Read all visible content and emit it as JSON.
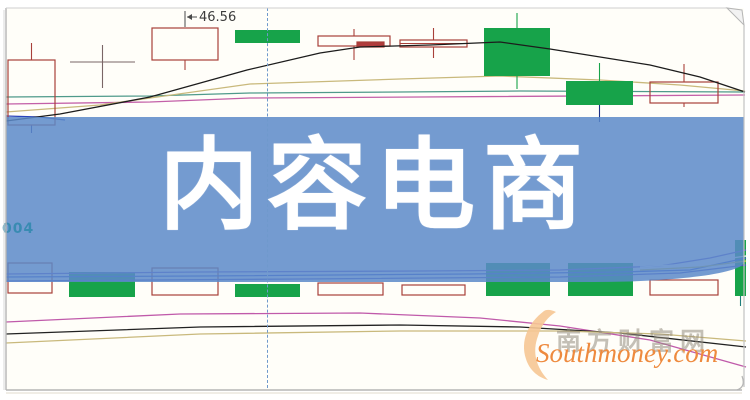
{
  "banner": {
    "title": "内容电商",
    "text_color": "#ffffff",
    "background": "rgba(92,138,201,0.85)"
  },
  "chart": {
    "price_label": "46.56",
    "left_axis_label": "004"
  },
  "watermark": {
    "site_name_cn": "南方财富网",
    "site_url": "Southmoney.com",
    "url_color": "#ee8a3e",
    "swoosh_color": "#f6c793"
  },
  "colors": {
    "red_outline": "#a8403a",
    "red_solid": "#b03c3c",
    "green": "#17a34a",
    "doji": "#7a6666",
    "chart_bg": "#fffef9",
    "frame": "#b5b5b5"
  },
  "chart_data": {
    "type": "candlestick",
    "title": "内容电商",
    "note": "Stock chart mostly covered by banner; no axis scale visible. Geometry given in screenshot pixel coordinates. Only labeled price value is 46.56.",
    "cursor_line": {
      "x": 267,
      "style": "dashed",
      "color": "#6f99cc"
    },
    "annotations": [
      {
        "text": "46.56",
        "x": 199,
        "y": 10,
        "callout_lines": [
          [
            [
              185,
              27
            ],
            [
              185,
              11
            ]
          ],
          [
            [
              187,
              17
            ],
            [
              197,
              17
            ]
          ]
        ]
      }
    ],
    "panes": {
      "price": {
        "ma_lines": [
          {
            "name": "ma-teal",
            "color": "#4f9a8b",
            "points": [
              [
                6,
                97
              ],
              [
                150,
                96
              ],
              [
                250,
                93
              ],
              [
                400,
                92
              ],
              [
                520,
                91
              ],
              [
                745,
                92
              ]
            ]
          },
          {
            "name": "ma-magenta",
            "color": "#c360a8",
            "points": [
              [
                6,
                104
              ],
              [
                150,
                102
              ],
              [
                250,
                98
              ],
              [
                420,
                97
              ],
              [
                745,
                95
              ]
            ]
          },
          {
            "name": "ma-tan",
            "color": "#c9b97c",
            "points": [
              [
                6,
                112
              ],
              [
                100,
                105
              ],
              [
                250,
                84
              ],
              [
                400,
                79
              ],
              [
                500,
                76
              ],
              [
                600,
                80
              ],
              [
                680,
                85
              ],
              [
                745,
                91
              ]
            ]
          },
          {
            "name": "ma-blue",
            "color": "#2a44bb",
            "points": [
              [
                6,
                116
              ],
              [
                40,
                117
              ],
              [
                65,
                120
              ]
            ]
          }
        ],
        "overlay_line": {
          "name": "ma-black",
          "color": "#1c1c1c",
          "points": [
            [
              6,
              121
            ],
            [
              60,
              114
            ],
            [
              150,
              97
            ],
            [
              247,
              70
            ],
            [
              320,
              53
            ],
            [
              360,
              47
            ],
            [
              430,
              45
            ],
            [
              500,
              42
            ],
            [
              550,
              49
            ],
            [
              650,
              65
            ],
            [
              700,
              77
            ],
            [
              745,
              92
            ]
          ]
        },
        "candles": [
          {
            "x": 8,
            "w": 47,
            "kind": "hollow",
            "body": [
              60,
              125
            ],
            "wick_top": 43,
            "wick_bottom": 133,
            "wick_bottom_color": "#2a3a9a"
          },
          {
            "x": 70,
            "w": 65,
            "kind": "doji",
            "body": [
              62,
              62
            ],
            "wick_top": 45,
            "wick_bottom": 88
          },
          {
            "x": 152,
            "w": 66,
            "kind": "hollow",
            "body": [
              28,
              60
            ],
            "wick_bottom": 70
          },
          {
            "x": 235,
            "w": 65,
            "kind": "green",
            "body": [
              30,
              43
            ]
          },
          {
            "x": 318,
            "w": 72,
            "kind": "hollow",
            "body": [
              36,
              46
            ],
            "wick_top": 29,
            "wick_bottom": 60
          },
          {
            "x": 357,
            "w": 27,
            "kind": "solid-red",
            "body": [
              42,
              47
            ]
          },
          {
            "x": 400,
            "w": 67,
            "kind": "hollow",
            "body": [
              40,
              47
            ],
            "wick_top": 28,
            "wick_bottom": 58,
            "midline": 43.5
          },
          {
            "x": 484,
            "w": 66,
            "kind": "green",
            "body": [
              28,
              76
            ],
            "wick_top": 13,
            "wick_bottom": 89
          },
          {
            "x": 566,
            "w": 67,
            "kind": "green",
            "body": [
              81,
              105
            ],
            "wick_top": 63,
            "wick_bottom": 122,
            "wick_bottom_color": "#1a2f86"
          },
          {
            "x": 650,
            "w": 68,
            "kind": "hollow",
            "body": [
              82,
              103
            ],
            "wick_top": 64,
            "wick_bottom": 107
          }
        ]
      },
      "volume": {
        "bars": [
          {
            "x": 8,
            "w": 44,
            "kind": "hollow",
            "body": [
              263,
              293
            ]
          },
          {
            "x": 69,
            "w": 66,
            "kind": "green",
            "body": [
              272,
              297
            ]
          },
          {
            "x": 152,
            "w": 66,
            "kind": "hollow",
            "body": [
              268,
              295
            ]
          },
          {
            "x": 235,
            "w": 65,
            "kind": "green",
            "body": [
              284,
              297
            ]
          },
          {
            "x": 318,
            "w": 65,
            "kind": "hollow",
            "body": [
              283,
              295
            ]
          },
          {
            "x": 402,
            "w": 63,
            "kind": "hollow",
            "body": [
              285,
              295
            ]
          },
          {
            "x": 486,
            "w": 64,
            "kind": "green",
            "body": [
              263,
              296
            ]
          },
          {
            "x": 568,
            "w": 65,
            "kind": "green",
            "body": [
              263,
              296
            ]
          },
          {
            "x": 650,
            "w": 68,
            "kind": "hollow",
            "body": [
              280,
              295
            ]
          },
          {
            "x": 735,
            "w": 11,
            "kind": "green",
            "body": [
              240,
              296
            ],
            "wick_bottom": 306,
            "wick_bottom_color": "#1f7d7d"
          }
        ],
        "ma_lines": [
          {
            "name": "vol-ma-violet",
            "color": "#6a5acd",
            "points": [
              [
                6,
                274
              ],
              [
                200,
                272
              ],
              [
                420,
                271
              ],
              [
                560,
                270
              ],
              [
                660,
                266
              ],
              [
                710,
                258
              ],
              [
                746,
                250
              ]
            ]
          },
          {
            "name": "vol-ma-blue",
            "color": "#3a55d0",
            "points": [
              [
                6,
                277
              ],
              [
                200,
                276
              ],
              [
                470,
                274
              ],
              [
                620,
                272
              ],
              [
                690,
                270
              ],
              [
                746,
                258
              ]
            ]
          },
          {
            "name": "vol-ma-indigo",
            "color": "#5050c8",
            "points": [
              [
                6,
                281
              ],
              [
                300,
                279
              ],
              [
                560,
                277
              ],
              [
                680,
                273
              ],
              [
                746,
                265
              ]
            ]
          },
          {
            "name": "vol-ma-white",
            "color": "#ffffff",
            "points": [
              [
                640,
                267
              ],
              [
                690,
                264
              ],
              [
                746,
                256
              ]
            ]
          },
          {
            "name": "vol-ma-yellow",
            "color": "#d6c544",
            "points": [
              [
                640,
                270
              ],
              [
                700,
                267
              ],
              [
                746,
                261
              ]
            ]
          }
        ],
        "indicator_lines": [
          {
            "name": "ind-magenta",
            "color": "#c05aaa",
            "points": [
              [
                6,
                322
              ],
              [
                180,
                314
              ],
              [
                360,
                313
              ],
              [
                480,
                318
              ],
              [
                560,
                326
              ],
              [
                650,
                340
              ],
              [
                746,
                367
              ]
            ]
          },
          {
            "name": "ind-black",
            "color": "#222222",
            "points": [
              [
                6,
                334
              ],
              [
                200,
                327
              ],
              [
                400,
                325
              ],
              [
                520,
                327
              ],
              [
                620,
                333
              ],
              [
                746,
                347
              ]
            ]
          },
          {
            "name": "ind-tan",
            "color": "#c9b97c",
            "points": [
              [
                6,
                343
              ],
              [
                200,
                334
              ],
              [
                400,
                331
              ],
              [
                560,
                331
              ],
              [
                660,
                334
              ],
              [
                746,
                341
              ]
            ]
          }
        ]
      }
    }
  }
}
